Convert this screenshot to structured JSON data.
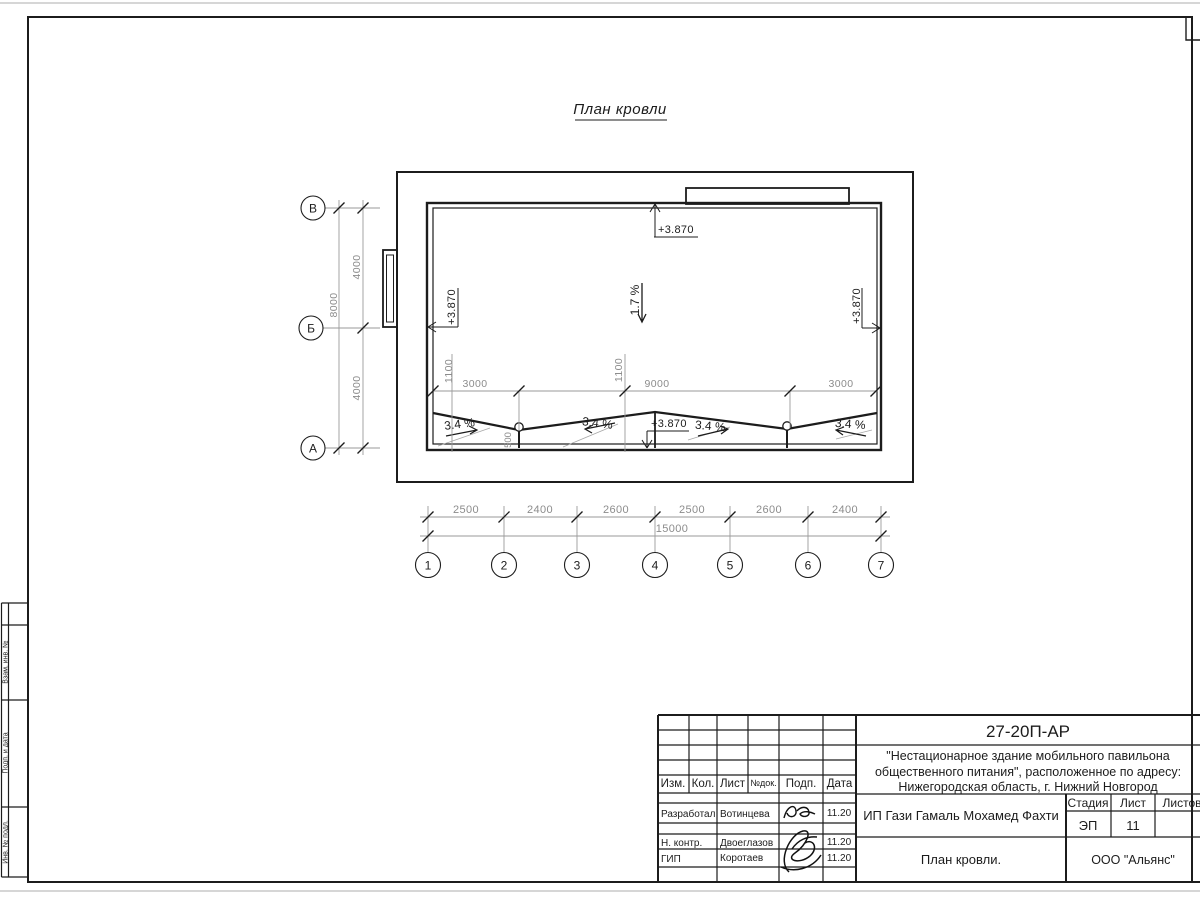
{
  "sheet": {
    "heading": "План кровли"
  },
  "axes": {
    "vertical": [
      "В",
      "Б",
      "А"
    ],
    "horizontal": [
      "1",
      "2",
      "3",
      "4",
      "5",
      "6",
      "7"
    ]
  },
  "dims": {
    "left_total": "8000",
    "left_segments": [
      "4000",
      "4000"
    ],
    "bottom_segments": [
      "2500",
      "2400",
      "2600",
      "2500",
      "2600",
      "2400"
    ],
    "bottom_total": "15000",
    "roof_row": [
      "3000",
      "9000",
      "3000"
    ],
    "roof_offsets": [
      "1100",
      "1100"
    ],
    "drain_dim": "500"
  },
  "marks": {
    "elevation": "+3.870",
    "main_slope": "1.7 %",
    "valley_slope": "3.4 %"
  },
  "stamp": {
    "doc_code": "27-20П-АР",
    "project_lines": [
      "\"Нестационарное здание мобильного павильона",
      "общественного питания\", расположенное по адресу:",
      "Нижегородская область, г. Нижний Новгород"
    ],
    "client": "ИП Гази Гамаль Мохамед Фахти",
    "drawing_title": "План кровли.",
    "company": "ООО \"Альянс\"",
    "stage_label": "Стадия",
    "sheet_label": "Лист",
    "sheets_label": "Листов",
    "stage": "ЭП",
    "sheet_number": "11",
    "header_cols": [
      "Изм.",
      "Кол.",
      "Лист",
      "№док.",
      "Подп.",
      "Дата"
    ],
    "rows": [
      {
        "role": "Разработал",
        "name": "Вотинцева",
        "date": "11.20"
      },
      {
        "role": "Н. контр.",
        "name": "Двоеглазов",
        "date": "11.20"
      },
      {
        "role": "ГИП",
        "name": "Коротаев",
        "date": "11.20"
      }
    ],
    "side_labels": [
      "Взам. инв. №",
      "Подп. и дата",
      "Инв. № подл."
    ]
  }
}
